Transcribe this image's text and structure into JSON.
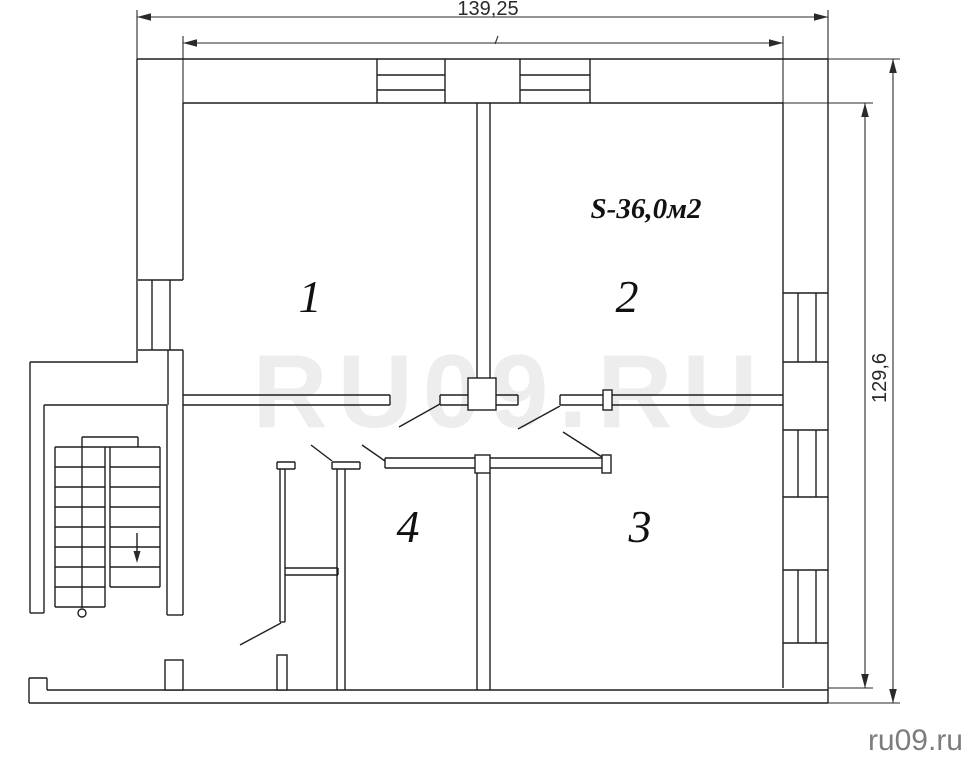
{
  "watermark": {
    "text": "RU09.RU"
  },
  "branding": {
    "site": "ru09.ru"
  },
  "plan": {
    "area_label": "S-36,0м2",
    "room_labels": {
      "room1": "1",
      "room2": "2",
      "room3": "3",
      "room4": "4"
    },
    "dimensions": {
      "width": "139,25",
      "height": "129,6"
    },
    "colors": {
      "line": "#1f1f1f",
      "dimension": "#2a2a2a",
      "watermark": "#ededed",
      "site": "#7d7d7d",
      "background": "#ffffff"
    }
  }
}
